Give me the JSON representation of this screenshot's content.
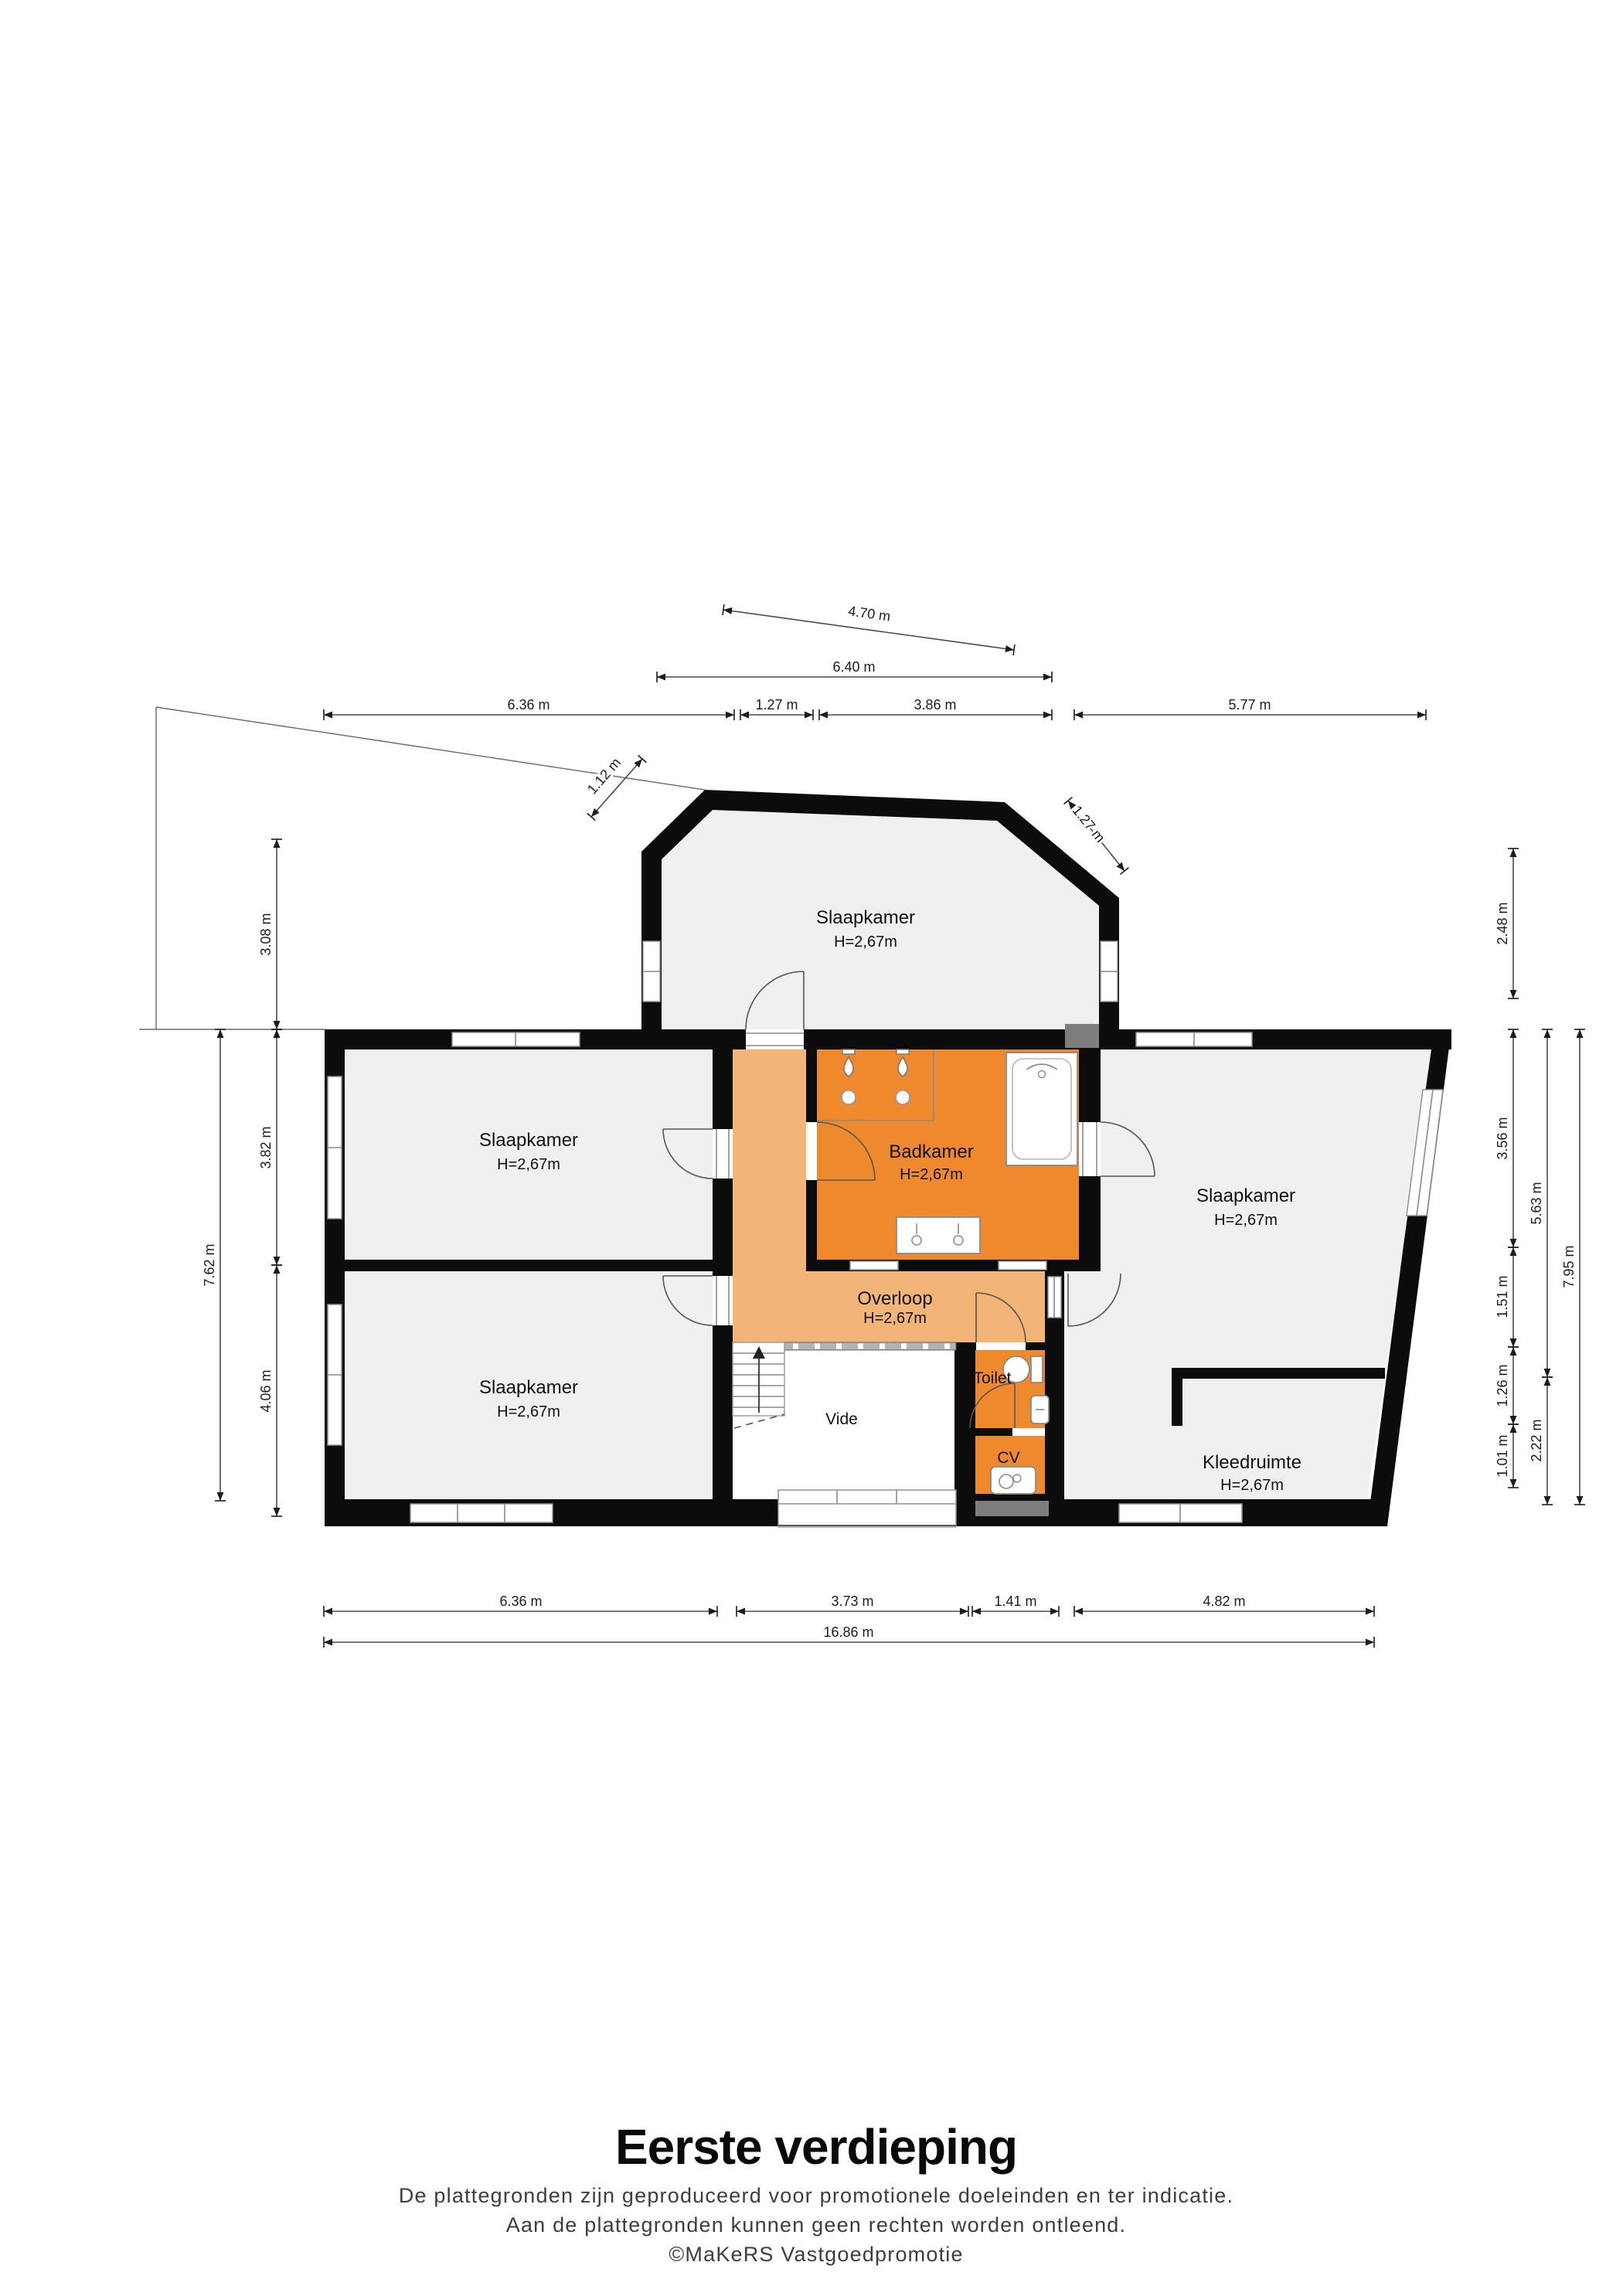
{
  "plan": {
    "colors": {
      "wall": "#0c0c0c",
      "room_gray": "#f0f0f0",
      "bath_orange": "#ee8a2d",
      "hall_orange": "#f3b577",
      "shaft_gray": "#7d7d7d"
    },
    "rooms": {
      "slaapkamer_top": {
        "name": "Slaapkamer",
        "height": "H=2,67m"
      },
      "slaapkamer_left": {
        "name": "Slaapkamer",
        "height": "H=2,67m"
      },
      "slaapkamer_left2": {
        "name": "Slaapkamer",
        "height": "H=2,67m"
      },
      "slaapkamer_right": {
        "name": "Slaapkamer",
        "height": "H=2,67m"
      },
      "badkamer": {
        "name": "Badkamer",
        "height": "H=2,67m"
      },
      "overloop": {
        "name": "Overloop",
        "height": "H=2,67m"
      },
      "kleedruimte": {
        "name": "Kleedruimte",
        "height": "H=2,67m"
      },
      "toilet": {
        "name": "Toilet"
      },
      "cv": {
        "name": "CV"
      },
      "vide": {
        "name": "Vide"
      }
    },
    "dims": {
      "t470": {
        "label": "4.70 m"
      },
      "t640": {
        "label": "6.40 m"
      },
      "t636": {
        "label": "6.36 m"
      },
      "t127": {
        "label": "1.27 m"
      },
      "t386": {
        "label": "3.86 m"
      },
      "t577": {
        "label": "5.77 m"
      },
      "t112": {
        "label": "1.12 m"
      },
      "t127d": {
        "label": "1.27 m"
      },
      "l308": {
        "label": "3.08 m"
      },
      "l762": {
        "label": "7.62 m"
      },
      "l382": {
        "label": "3.82 m"
      },
      "l406": {
        "label": "4.06 m"
      },
      "r248": {
        "label": "2.48 m"
      },
      "r356": {
        "label": "3.56 m"
      },
      "r151": {
        "label": "1.51 m"
      },
      "r126": {
        "label": "1.26 m"
      },
      "r101": {
        "label": "1.01 m"
      },
      "r563": {
        "label": "5.63 m"
      },
      "r222": {
        "label": "2.22 m"
      },
      "r795": {
        "label": "7.95 m"
      },
      "b636": {
        "label": "6.36 m"
      },
      "b373": {
        "label": "3.73 m"
      },
      "b141": {
        "label": "1.41 m"
      },
      "b482": {
        "label": "4.82 m"
      },
      "b1686": {
        "label": "16.86 m"
      }
    }
  },
  "footer": {
    "title": "Eerste verdieping",
    "line1": "De plattegronden zijn geproduceerd voor promotionele doeleinden en ter indicatie.",
    "line2": "Aan de plattegronden kunnen geen rechten worden ontleend.",
    "credit": "©MaKeRS Vastgoedpromotie"
  }
}
